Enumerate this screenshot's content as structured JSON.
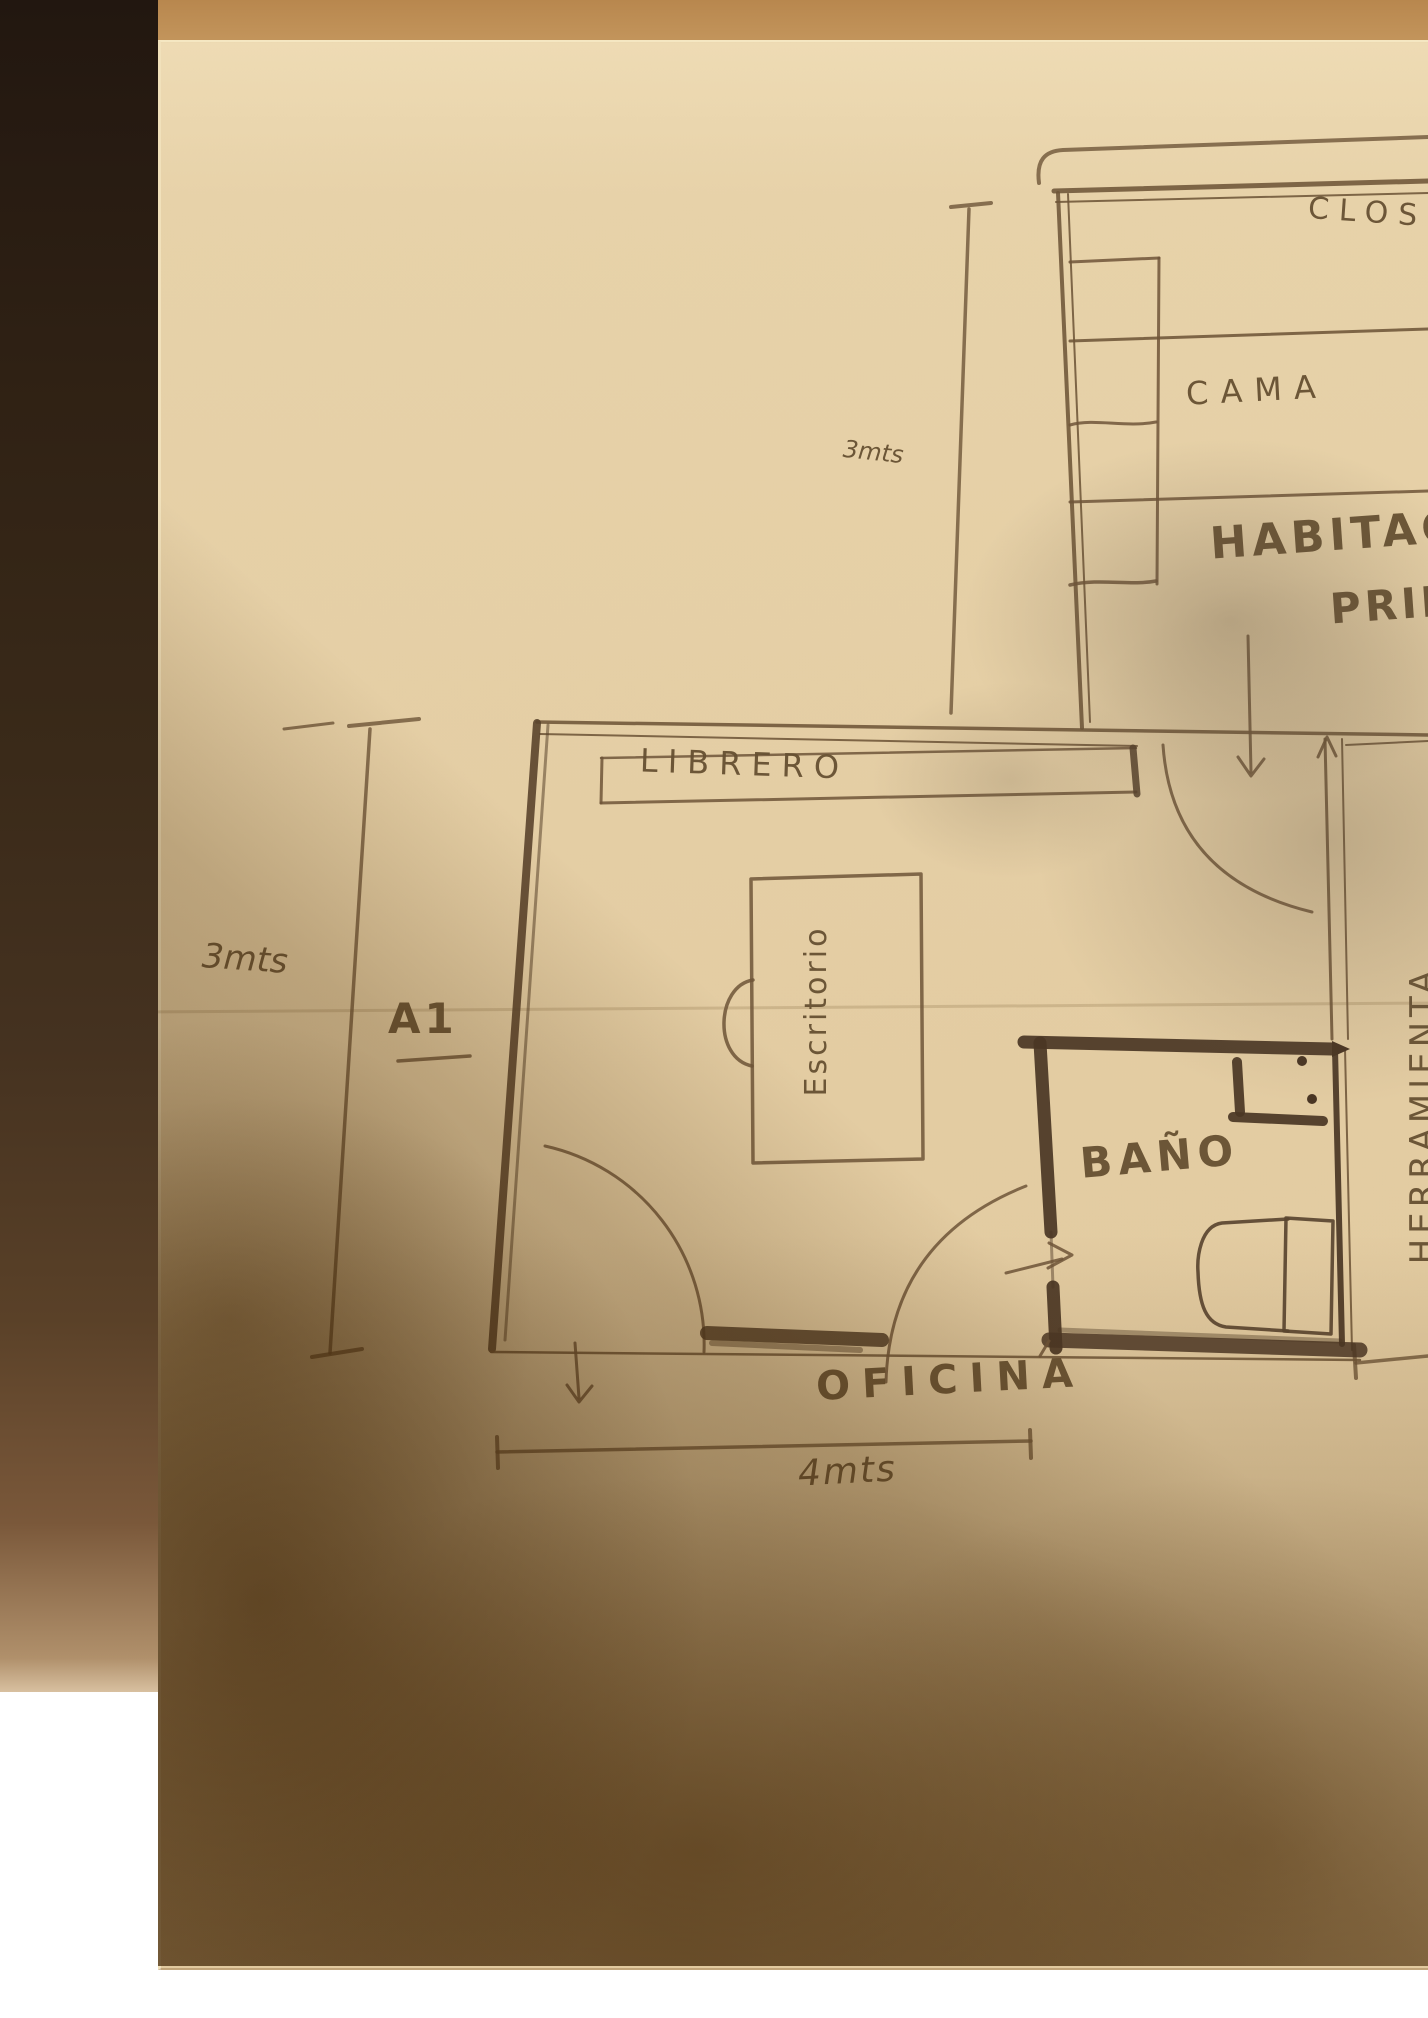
{
  "title": "Hand-drawn floor plan sketch (pencil on paper photo)",
  "labels": {
    "closet": "CLOS",
    "bed": "CAMA",
    "bedroom_line1": "HABITAC",
    "bedroom_line2": "PRIN",
    "bookshelf": "LIBRERO",
    "desk": "Escritorio",
    "bathroom": "BAÑO",
    "office": "OFICINA",
    "tool_room": "HERRAMIENTA",
    "area_code": "A1"
  },
  "dimensions": {
    "bedroom_depth": "3mts",
    "office_depth": "3mts",
    "office_width": "4mts"
  },
  "colors": {
    "paper": "#e3cca2",
    "pencil": "#6b5339",
    "dark_wall": "#4a3524",
    "table_edge": "#2f2114",
    "table_top": "#c3955c",
    "shadow": "#6a4212"
  }
}
